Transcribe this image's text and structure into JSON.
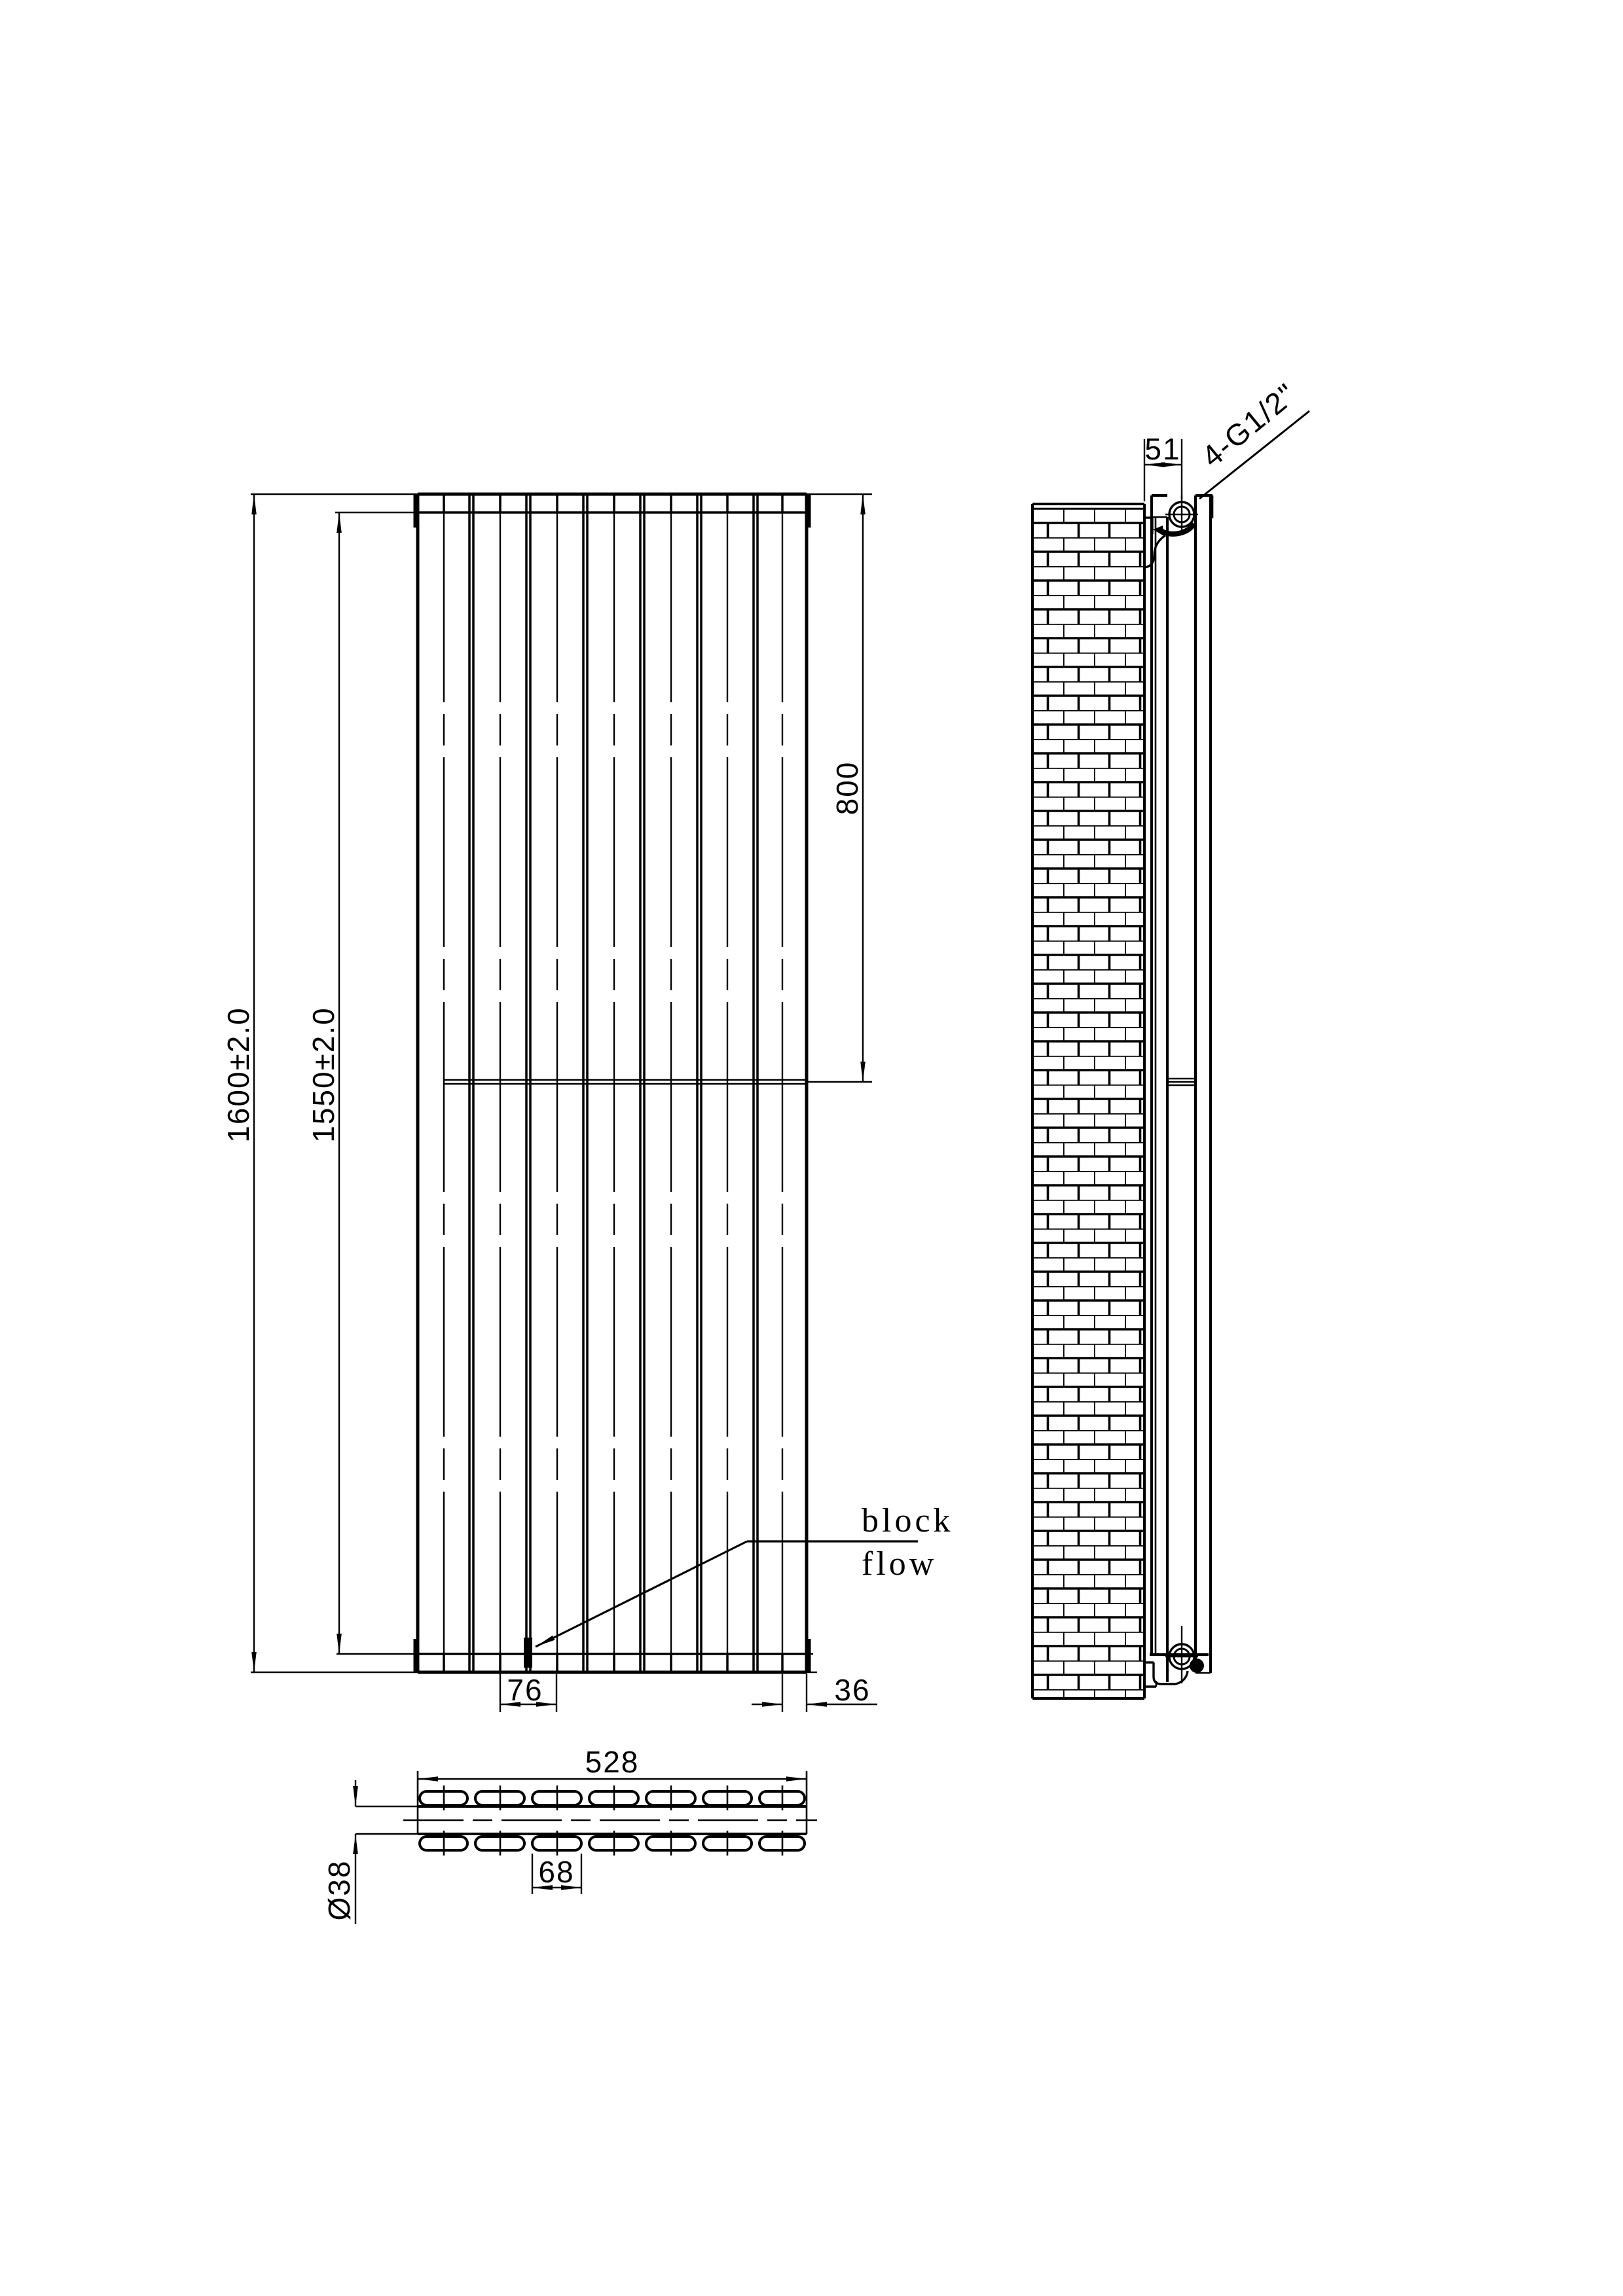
{
  "front_view": {
    "overall_height": "1600±2.0",
    "tube_height": "1550±2.0",
    "upper_section_height": "800",
    "panel_pitch": "76",
    "edge_offset": "36",
    "block_label": "block",
    "flow_label": "flow"
  },
  "bottom_view": {
    "overall_width": "528",
    "tube_width": "68",
    "collector_diameter": "Ø38"
  },
  "side_view": {
    "wall_clearance": "51",
    "connection_thread": "4-G1/2\""
  }
}
